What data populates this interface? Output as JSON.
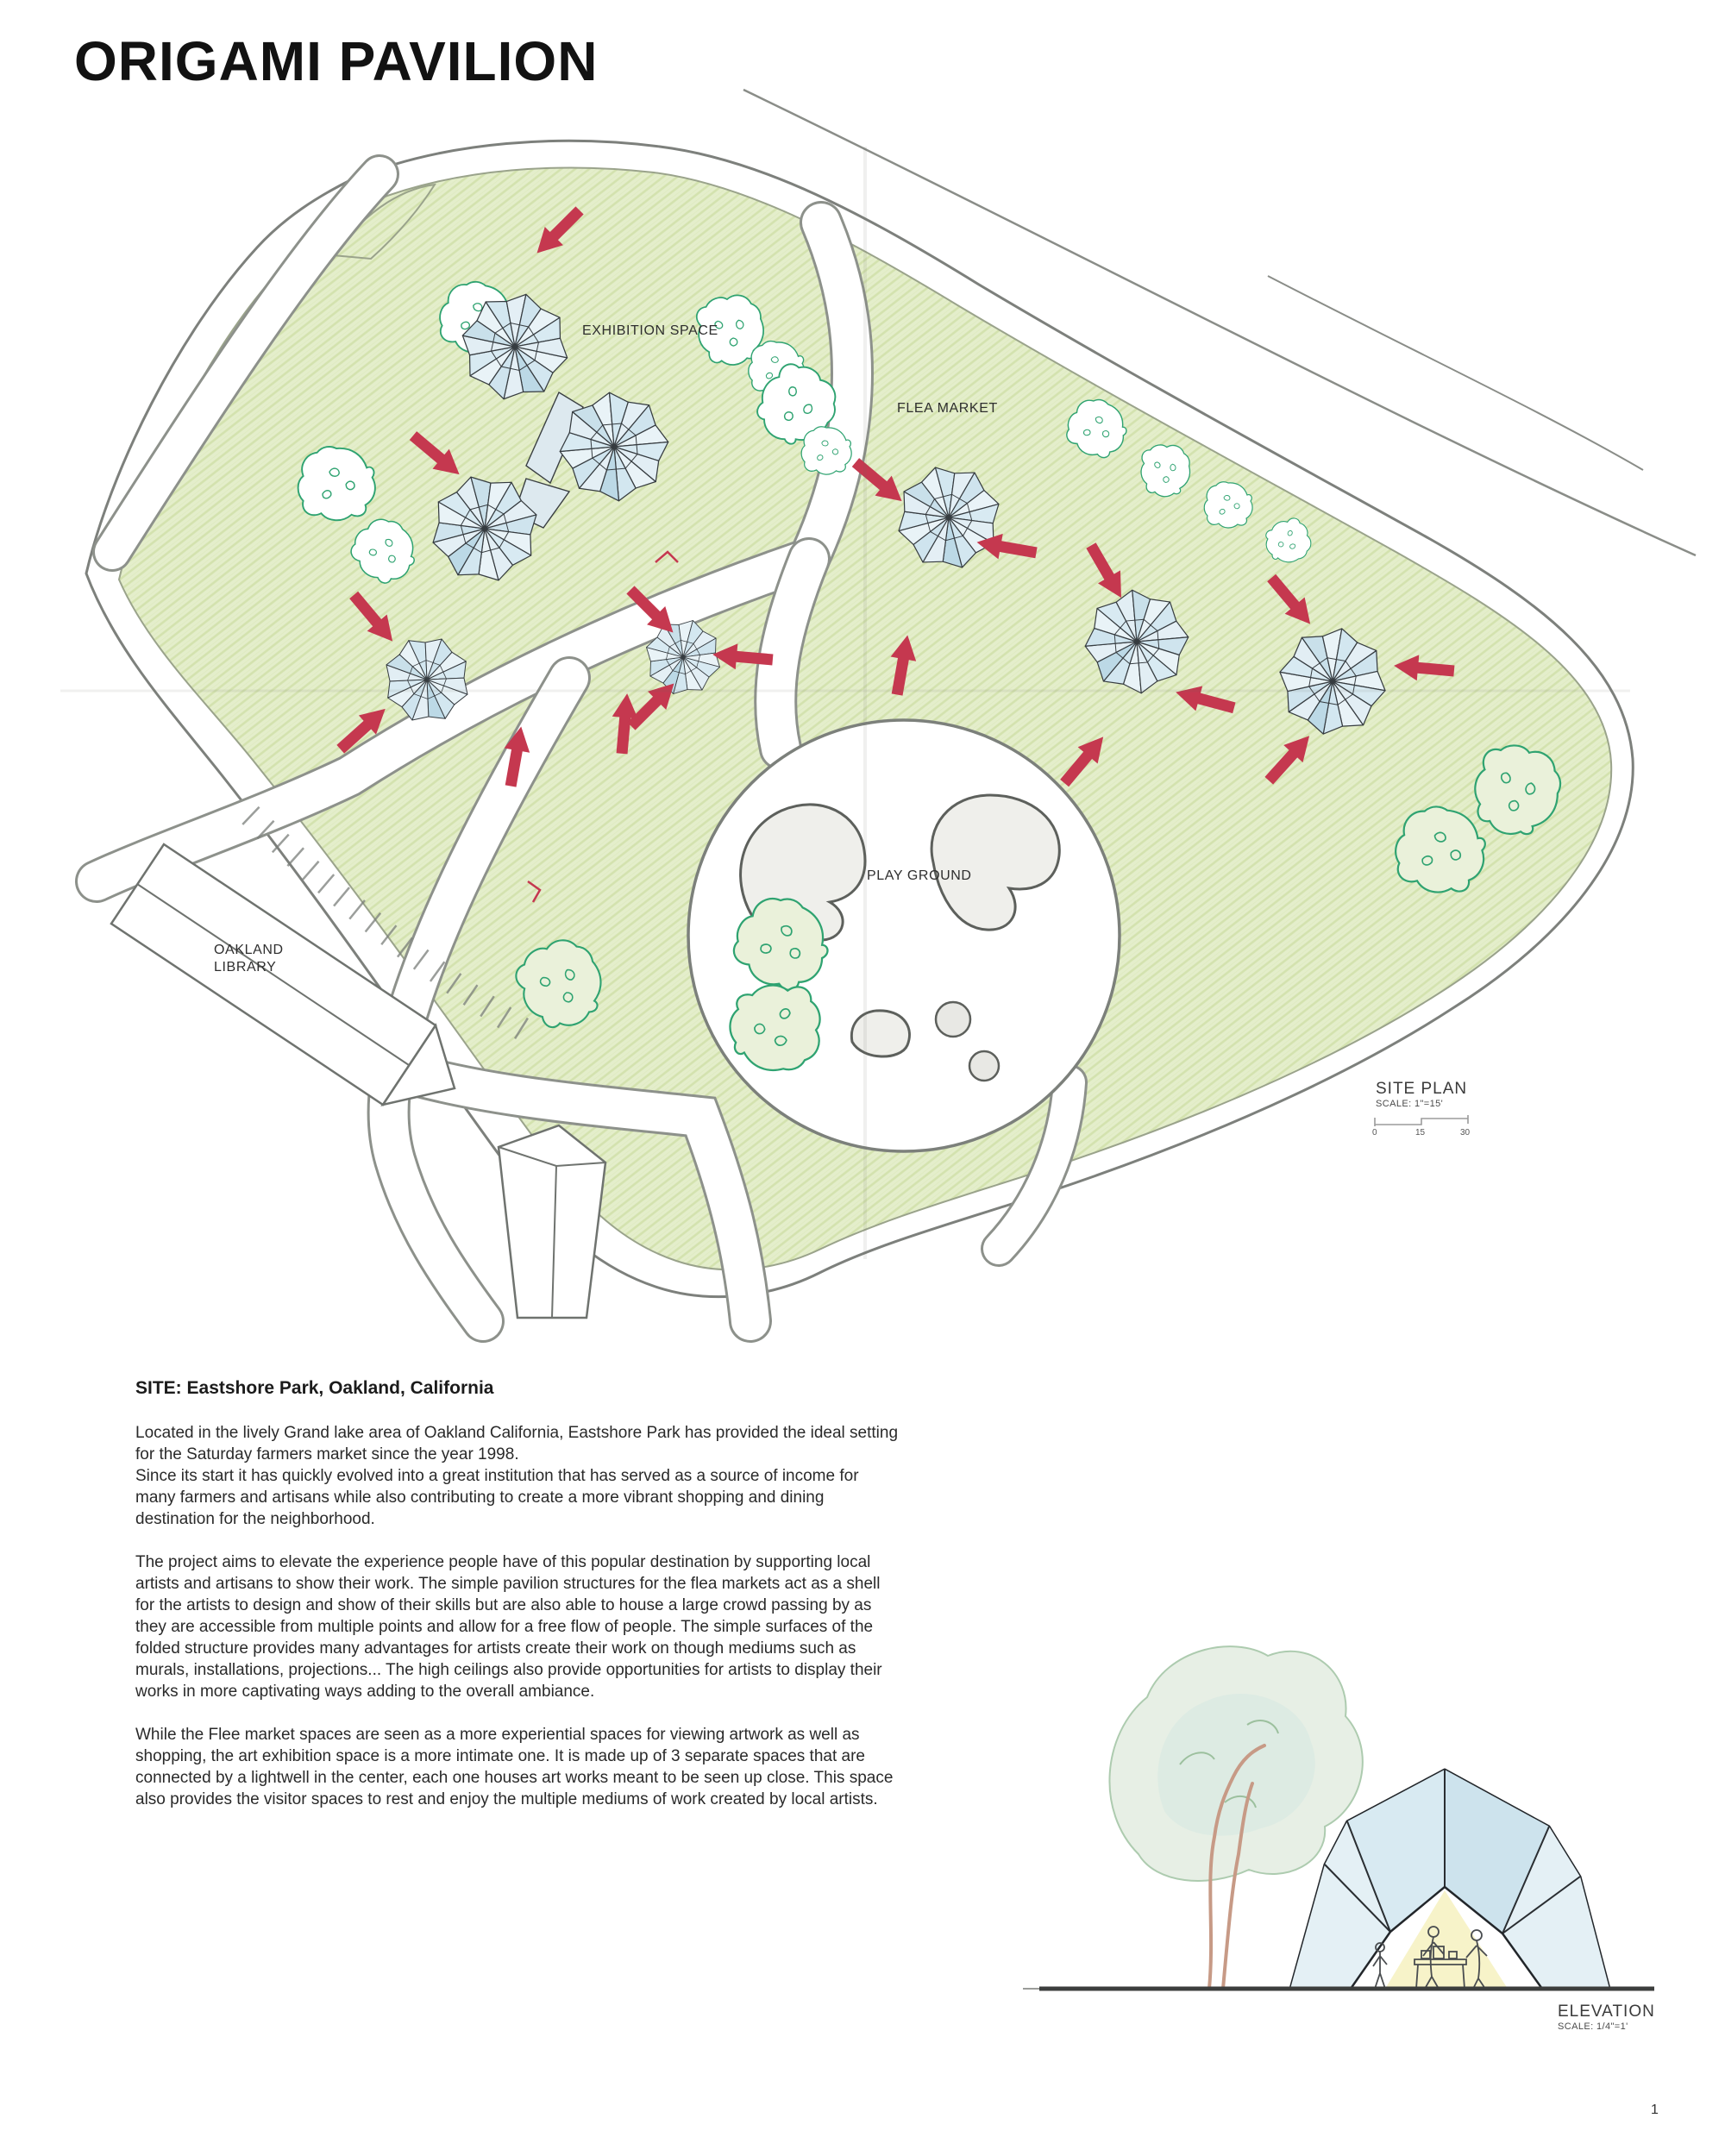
{
  "page": {
    "title": "ORIGAMI PAVILION",
    "page_number": "1"
  },
  "site_plan": {
    "labels": {
      "exhibition_space": "EXHIBITION SPACE",
      "flea_market": "FLEA MARKET",
      "play_ground": "PLAY GROUND",
      "library": "OAKLAND\nLIBRARY",
      "title": "SITE PLAN",
      "scale": "SCALE: 1\"=15'",
      "scalebar": {
        "zero": "0",
        "mid": "15",
        "end": "30"
      }
    }
  },
  "description": {
    "heading": "SITE: Eastshore Park, Oakland, California",
    "paragraphs": [
      "Located in the lively Grand lake area of Oakland California, Eastshore Park has provided the ideal setting for the Saturday farmers market since the year 1998.\nSince its start it has quickly evolved into a great institution that has served as a source of income for many farmers and artisans while also contributing to create a more vibrant shopping and dining destination for the neighborhood.",
      "The project aims to elevate the experience people have of this popular destination by supporting local artists and artisans to show their work. The simple pavilion structures for the flea markets act as a shell for the artists to design and show of their skills but are also able to house a large crowd passing by as they are accessible from multiple points and allow for a free flow of people. The simple surfaces of the folded structure provides many advantages for artists create their work on though mediums such as murals, installations, projections... The high ceilings also provide opportunities for artists to display their works in more captivating ways adding to the overall ambiance.",
      "While the Flee market spaces are seen as a more experiential spaces for viewing artwork as well as shopping, the art exhibition space is a more intimate one. It is made up of 3 separate spaces that are connected by a lightwell in the center, each one houses art works meant to be seen up close. This space also provides the visitor spaces to rest and enjoy the multiple mediums of work created by local artists."
    ]
  },
  "elevation": {
    "title": "ELEVATION",
    "scale": "SCALE: 1/4\"=1'"
  },
  "colors": {
    "lawn": "#e3edca",
    "tree_outline": "#2fa371",
    "structure_fill": "#e8f2f7",
    "arrow_red": "#c5384f",
    "pencil": "#8a8d88"
  }
}
